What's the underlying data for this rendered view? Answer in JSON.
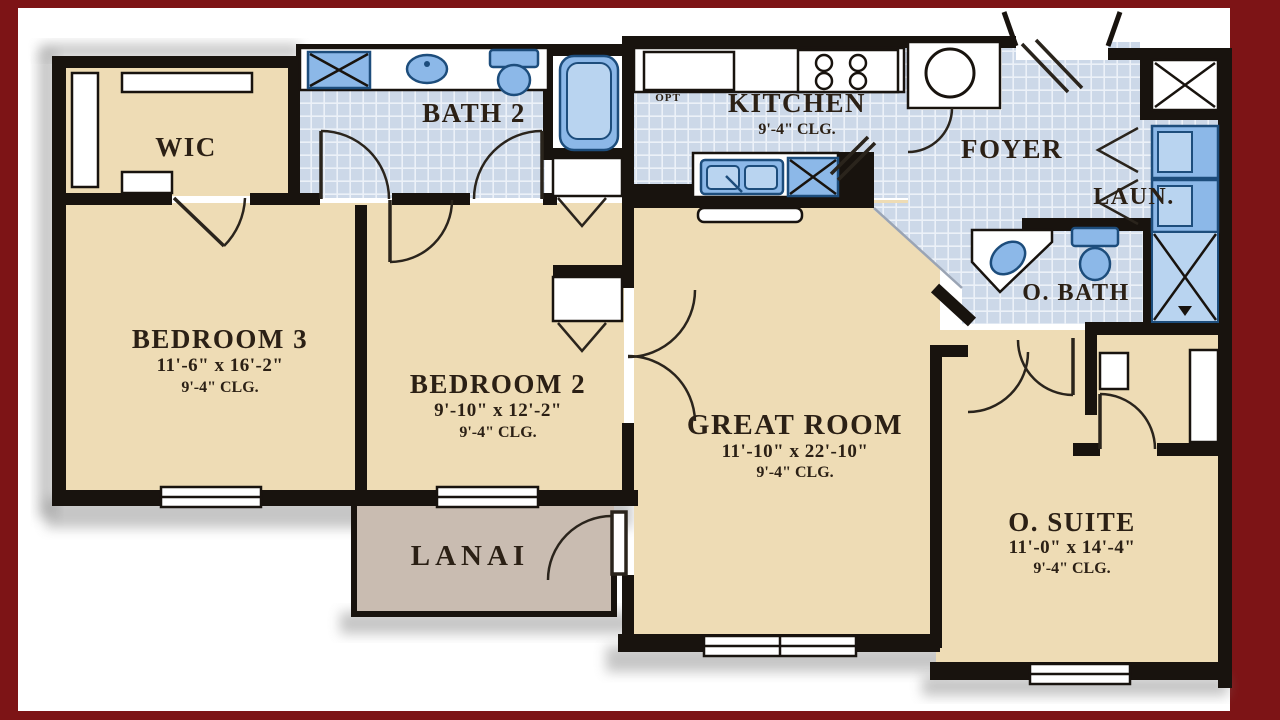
{
  "title": "Residential Floor Plan",
  "colors": {
    "border": "#7d1416",
    "white": "#ffffff",
    "wall": "#18130e",
    "beige": "#eedcb5",
    "tile": "#ccd8e8",
    "tile-line": "#ecf1f8",
    "lanai": "#c9bcb1",
    "fixture": "#8cb8e8",
    "fixture-dark": "#1d4d7c",
    "fixture-light": "#b9d4f0",
    "door": "#2a241c",
    "ink": "#2b2015",
    "shadow": "#808080"
  },
  "rooms": {
    "wic": {
      "name": "WIC"
    },
    "bath2": {
      "name": "BATH 2"
    },
    "kitchen": {
      "name": "KITCHEN",
      "clg": "9'-4\" CLG.",
      "opt": "OPT"
    },
    "foyer": {
      "name": "FOYER"
    },
    "laundry": {
      "name": "LAUN."
    },
    "obath": {
      "name": "O. BATH"
    },
    "bedroom3": {
      "name": "BEDROOM 3",
      "dims": "11'-6\" x 16'-2\"",
      "clg": "9'-4\" CLG."
    },
    "bedroom2": {
      "name": "BEDROOM 2",
      "dims": "9'-10\" x 12'-2\"",
      "clg": "9'-4\" CLG."
    },
    "greatroom": {
      "name": "GREAT ROOM",
      "dims": "11'-10\" x 22'-10\"",
      "clg": "9'-4\" CLG."
    },
    "osuite": {
      "name": "O. SUITE",
      "dims": "11'-0\" x 14'-4\"",
      "clg": "9'-4\" CLG."
    },
    "lanai": {
      "name": "LANAI"
    }
  }
}
